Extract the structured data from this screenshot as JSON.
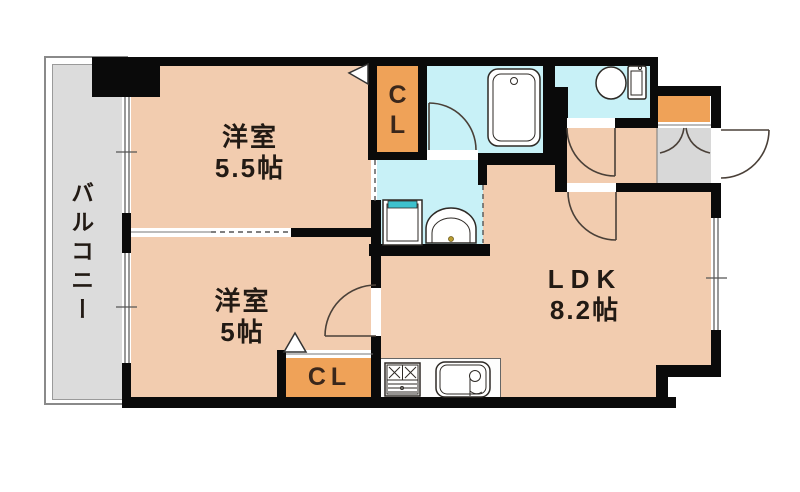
{
  "colors": {
    "peach": "#F2CCAF",
    "orange": "#EFA258",
    "cyan": "#C8F1F7",
    "balcony_gray": "#DCDCDC",
    "genkan_gray": "#D8D8D8",
    "wall": "#0A0A0A",
    "teal": "#3EC1CD",
    "basin_yellow": "#F8F4C6"
  },
  "rooms": {
    "balcony": {
      "label": "バルコニー"
    },
    "bedroom_upper": {
      "name": "洋室",
      "size": "5.5帖"
    },
    "bedroom_lower": {
      "name": "洋室",
      "size": "5帖"
    },
    "ldk": {
      "name": "LDK",
      "size": "8.2帖"
    },
    "closet_upper": {
      "line1": "C",
      "line2": "L"
    },
    "closet_lower": {
      "label": "CL"
    }
  }
}
